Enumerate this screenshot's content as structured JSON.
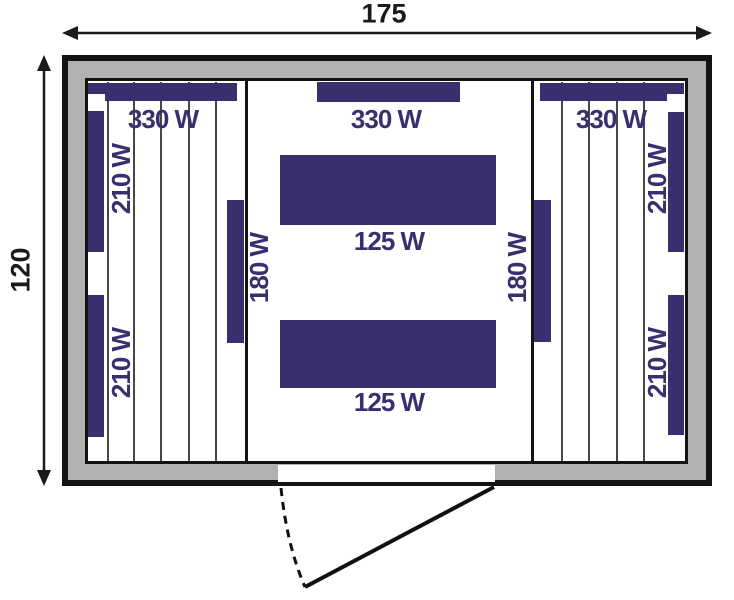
{
  "dimensions": {
    "width": "175",
    "height": "120"
  },
  "heaters": {
    "left_top": "330 W",
    "center_top": "330 W",
    "right_top": "330 W",
    "left_wall_upper": "210 W",
    "left_wall_lower": "210 W",
    "right_wall_upper": "210 W",
    "right_wall_lower": "210 W",
    "left_front": "180 W",
    "right_front": "180 W",
    "center_upper": "125 W",
    "center_lower": "125 W"
  },
  "colors": {
    "heater": "#38306e",
    "wall": "#b1b1b1",
    "outline": "#141414",
    "dimension_text": "#1a1a1a"
  }
}
